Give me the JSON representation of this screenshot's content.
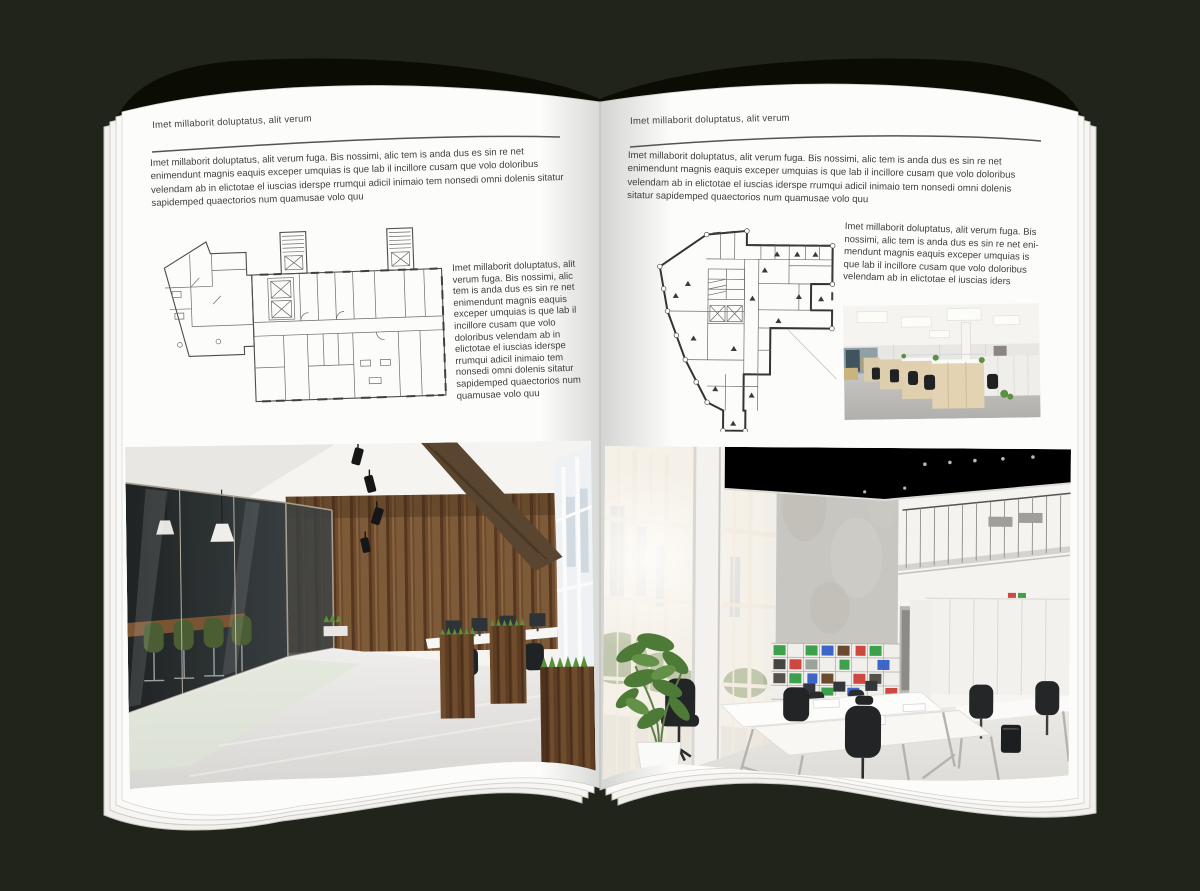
{
  "palette": {
    "background": "#21241a",
    "cover_edge": "#0b0d05",
    "page": "#fcfcfa",
    "text": "#403f3c",
    "rule": "#55544e",
    "plan_line": "#56564f",
    "wood_wall": "#6e4b2d",
    "plant_green": "#5a8f3b",
    "chair_green": "#4b5d33",
    "binder_green": "#3da14c",
    "binder_red": "#cf4840",
    "binder_blue": "#3e66c9"
  },
  "left_page": {
    "header": "Imet millaborit doluptatus, alit verum",
    "intro": "Imet millaborit doluptatus, alit verum fuga. Bis nossimi, alic tem is anda dus es sin re net enimendunt magnis eaquis exceper umquias is que lab il incillore cusam que volo doloribus velendam ab in elictotae el iuscias iderspe rrumqui adicil inimaio tem nonsedi omni dolenis sitatur sapidemped quaectorios num quamusae volo quu",
    "sidebar": "Imet millaborit doluptatus, alit verum fuga. Bis nossimi, alic tem is anda dus es sin re net enimendunt magnis eaquis exceper umquias is que lab il incillore cusam que volo doloribus velendam ab in elictotae el iuscias iderspe rrumqui adicil inimaio tem nonsedi omni dolenis sitatur sapidemped quaectorios num quamusae volo quu"
  },
  "right_page": {
    "header": "Imet millaborit doluptatus, alit verum",
    "intro": "Imet millaborit doluptatus, alit verum fuga. Bis nossimi, alic tem is anda dus es sin re net enimendunt magnis eaquis exceper umquias is que lab il incillore cusam que volo doloribus velendam ab in elictotae el iuscias iderspe rrumqui adicil inimaio tem nonsedi omni dolenis sitatur sapidemped quaectorios num quamusae volo quu",
    "sidebar": "Imet millaborit doluptatus, alit verum fuga. Bis nossimi, alic tem is anda dus es sin re net eni­mendunt magnis eaquis exceper umquias is que lab il incillore cusam que volo doloribus velendam ab in elictotae el iuscias iders"
  }
}
